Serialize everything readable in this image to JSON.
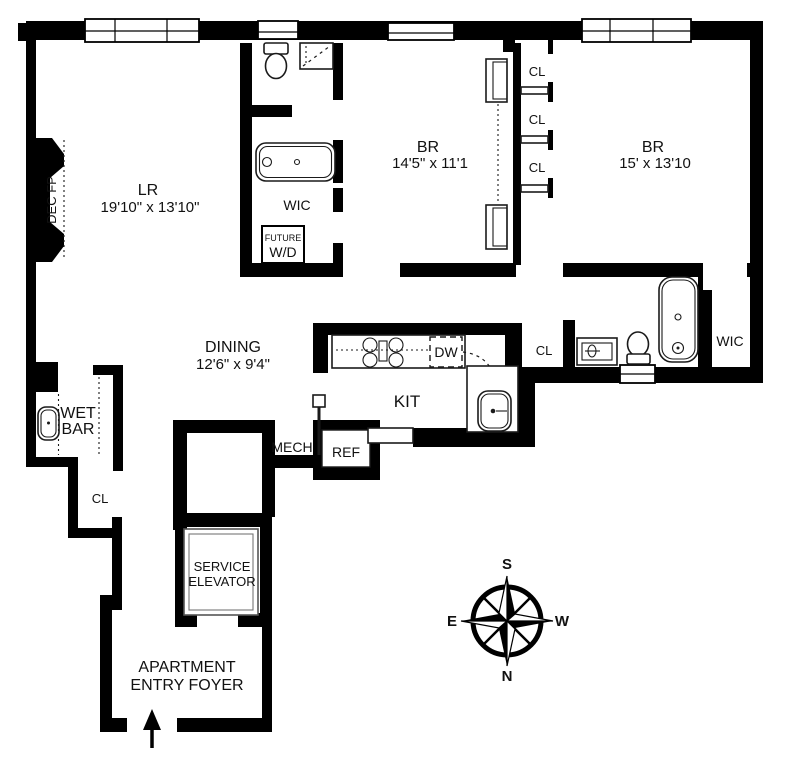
{
  "floorplan": {
    "living_room": {
      "name": "LR",
      "dims": "19'10\" x 13'10\""
    },
    "bedroom1": {
      "name": "BR",
      "dims": "14'5\" x 11'1"
    },
    "bedroom2": {
      "name": "BR",
      "dims": "15' x 13'10"
    },
    "dining": {
      "name": "DINING",
      "dims": "12'6\" x 9'4\""
    },
    "kitchen": {
      "name": "KIT"
    },
    "dishwasher": "DW",
    "refrigerator": "REF",
    "mechanical": "MECH",
    "wet_bar": {
      "line1": "WET",
      "line2": "BAR"
    },
    "future_wd": {
      "line1": "FUTURE",
      "line2": "W/D"
    },
    "walk_in_closet1": "WIC",
    "walk_in_closet2": "WIC",
    "closet1": "CL",
    "closet2": "CL",
    "closet3": "CL",
    "hall_closet": "CL",
    "foyer_closet": "CL",
    "fireplace": "DEC FP",
    "service_elevator": {
      "line1": "SERVICE",
      "line2": "ELEVATOR"
    },
    "entry_foyer": {
      "line1": "APARTMENT",
      "line2": "ENTRY FOYER"
    },
    "compass": {
      "north": "N",
      "south": "S",
      "east": "E",
      "west": "W"
    },
    "colors": {
      "wall": "#000000",
      "background": "#ffffff"
    }
  }
}
